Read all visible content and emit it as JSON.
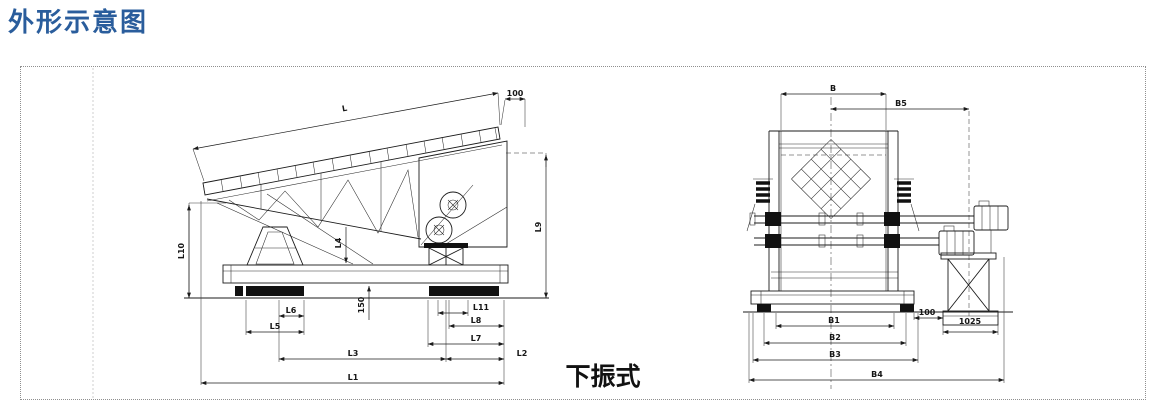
{
  "title": "外形示意图",
  "caption": "下振式",
  "side": {
    "L": "L",
    "L1": "L1",
    "L2": "L2",
    "L3": "L3",
    "L4": "L4",
    "L5": "L5",
    "L6": "L6",
    "L7": "L7",
    "L8": "L8",
    "L9": "L9",
    "L10": "L10",
    "L11": "L11",
    "top_offset": "100",
    "pad_height": "150"
  },
  "front": {
    "B": "B",
    "B1": "B1",
    "B2": "B2",
    "B3": "B3",
    "B4": "B4",
    "B5": "B5",
    "gap": "100",
    "stand_width": "1025"
  },
  "colors": {
    "title_blue": "#2a5d9c",
    "line_black": "#1b1b1b"
  }
}
